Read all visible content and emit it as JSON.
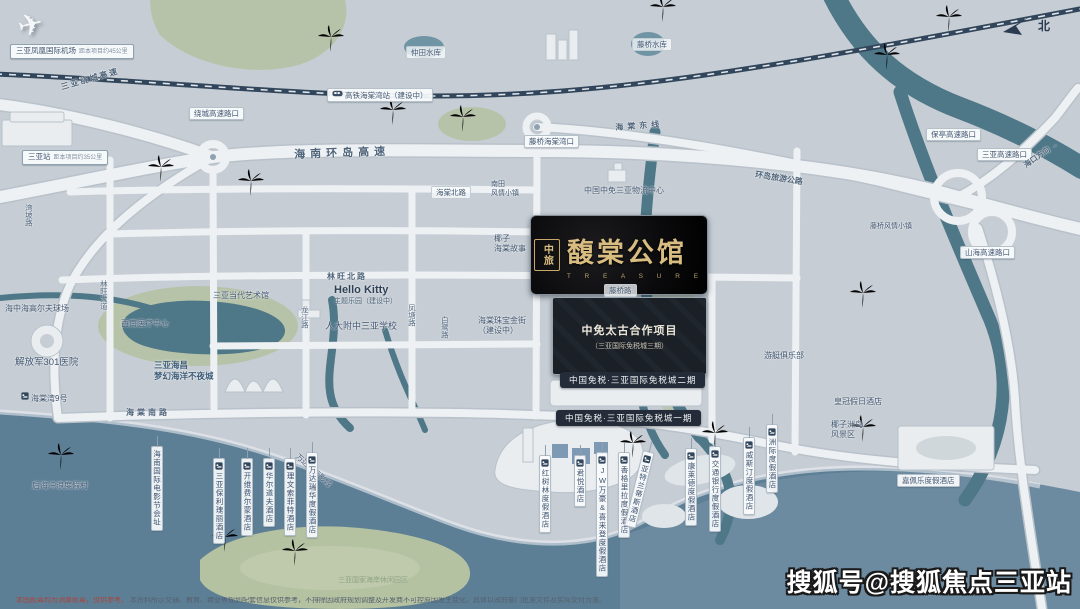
{
  "watermark": "搜狐号@搜狐焦点三亚站",
  "compass_label": "北",
  "logo": {
    "seal": "中旅",
    "name": "馥棠公馆",
    "sub": "T R E A S U R E"
  },
  "duty_free": {
    "project_line1": "中免太古合作项目",
    "project_line2": "（三亚国际免税城三期）",
    "phase2": "中国免税·三亚国际免税城二期",
    "phase1": "中国免税·三亚国际免税城一期"
  },
  "hello_kitty": {
    "title": "Hello Kitty",
    "sub": "主题乐园（建设中）"
  },
  "disclaimer": {
    "red": "本图距离均为测算距离，仅供参考。",
    "gray": "本资料所示交通、教育、商业等规划配套信息仅供参考，不排除因政府规划调整及开发商不可控原因发生变化，具体以政府部门批准文件及实际交付为准。"
  },
  "colors": {
    "bg": "#c6cdd4",
    "sea": "#5d7f96",
    "river": "#4e7787",
    "green": "#b7c3a9",
    "road": "#eef1f4",
    "rail": "#31455b",
    "gold": "#d9bc80",
    "dark_pill": "#232c38"
  },
  "labels": [
    {
      "n": "airport-label",
      "c": "p brd",
      "t": "三亚凤凰国际机场",
      "x": 10,
      "y": 44,
      "note": "距本项目约45公里"
    },
    {
      "n": "sanya-station-label",
      "c": "p brd",
      "t": "三亚站",
      "x": 22,
      "y": 150,
      "note": "距本项目约35公里"
    },
    {
      "n": "rail-station-label",
      "c": "p",
      "t": "高铁海棠湾站（建设中）",
      "x": 327,
      "y": 88,
      "train": 1
    },
    {
      "n": "raocheng-exit-label",
      "c": "p",
      "t": "绕城高速路口",
      "x": 189,
      "y": 107
    },
    {
      "n": "tengqiao-exit-label",
      "c": "p",
      "t": "藤桥海棠湾口",
      "x": 524,
      "y": 135
    },
    {
      "n": "baoting-exit-label",
      "c": "p",
      "t": "保亭高速路口",
      "x": 926,
      "y": 128
    },
    {
      "n": "sanya-exit-label",
      "c": "p",
      "t": "三亚高速路口",
      "x": 977,
      "y": 148
    },
    {
      "n": "shanhai-exit-label",
      "c": "p",
      "t": "山海高速路口",
      "x": 960,
      "y": 246
    },
    {
      "n": "zhongtian-reservoir-label",
      "c": "p soft",
      "t": "仲田水库",
      "x": 406,
      "y": 46
    },
    {
      "n": "tengqiao-reservoir-label",
      "c": "p soft",
      "t": "藤桥水库",
      "x": 632,
      "y": 38
    },
    {
      "n": "haitang-north-road-label",
      "c": "p soft",
      "t": "海棠北路",
      "x": 431,
      "y": 186
    },
    {
      "n": "tengqiao-road-label",
      "c": "p soft",
      "t": "藤桥路",
      "x": 604,
      "y": 284
    },
    {
      "n": "capella-hotel-label",
      "c": "p",
      "t": "嘉佩乐度假酒店",
      "x": 897,
      "y": 474
    },
    {
      "n": "raocheng-expressway-label",
      "c": "lab rt",
      "t": "三亚绕城高速",
      "x": 60,
      "y": 83,
      "rot": -16,
      "sp": 2
    },
    {
      "n": "island-ring-expressway-label",
      "c": "lab rt",
      "t": "海南环岛高速",
      "x": 294,
      "y": 149,
      "rot": -2,
      "sp": 5,
      "size": 11
    },
    {
      "n": "haitang-east-line-label",
      "c": "lab rt",
      "t": "海棠东线",
      "x": 615,
      "y": 123,
      "rot": -4,
      "sp": 4
    },
    {
      "n": "island-tour-road-label",
      "c": "lab rt",
      "t": "环岛旅游公路",
      "x": 756,
      "y": 170,
      "rot": 9
    },
    {
      "n": "haikou-direction-label",
      "c": "lab rt",
      "t": "海口方向 →",
      "x": 1022,
      "y": 162,
      "rot": -35,
      "size": 7.5
    },
    {
      "n": "linwang-north-road-label",
      "c": "lab rt",
      "t": "林旺北路",
      "x": 327,
      "y": 272,
      "sp": 2
    },
    {
      "n": "haitang-south-road-label",
      "c": "lab rt",
      "t": "海棠南路",
      "x": 126,
      "y": 408,
      "sp": 3
    },
    {
      "n": "wanpo-road-label",
      "c": "rv",
      "t": "湾坡路",
      "x": 24,
      "y": 204
    },
    {
      "n": "linwang-avenue-label",
      "c": "rv",
      "t": "林旺大道",
      "x": 99,
      "y": 280
    },
    {
      "n": "longjiang-road-label",
      "c": "rv",
      "t": "龙江路",
      "x": 300,
      "y": 306
    },
    {
      "n": "fengtang-road-label",
      "c": "rv",
      "t": "凤塘路",
      "x": 407,
      "y": 304
    },
    {
      "n": "bailu-road-label",
      "c": "rv",
      "t": "白鹭路",
      "x": 440,
      "y": 316
    },
    {
      "n": "cdf-logistics-label",
      "c": "lab poi",
      "t": "中国中免三亚物流中心",
      "x": 584,
      "y": 186
    },
    {
      "n": "contemporary-art-museum-label",
      "c": "lab poi",
      "t": "三亚当代艺术馆",
      "x": 213,
      "y": 291
    },
    {
      "n": "golf-club-label",
      "c": "lab poi",
      "t": "海中海高尔夫球场",
      "x": 5,
      "y": 304
    },
    {
      "n": "medical-center-label",
      "c": "lab poi",
      "t": "西南医疗中心",
      "x": 121,
      "y": 319
    },
    {
      "n": "hospital-301-label",
      "c": "lab poi",
      "t": "解放军301医院",
      "x": 15,
      "y": 357,
      "size": 9.5
    },
    {
      "n": "haitangwan-no9-label",
      "c": "lab poi",
      "t": "海棠湾9号",
      "x": 21,
      "y": 392,
      "bed": 1
    },
    {
      "n": "nantian-town-label",
      "c": "lab poi",
      "lines": [
        "南田",
        "风情小镇"
      ],
      "x": 491,
      "y": 181,
      "size": 7
    },
    {
      "n": "haichang-ocean-town-label",
      "c": "lab poi strong",
      "lines": [
        "三亚海昌",
        "梦幻海洋不夜城"
      ],
      "x": 154,
      "y": 360,
      "size": 8.5
    },
    {
      "n": "rdfz-school-label",
      "c": "lab poi",
      "t": "人大附中三亚学校",
      "x": 325,
      "y": 321,
      "size": 9
    },
    {
      "n": "jewelry-street-label",
      "c": "lab poi",
      "lines": [
        "海棠珠宝金街",
        "（建设中）"
      ],
      "x": 478,
      "y": 316
    },
    {
      "n": "coconut-story-label",
      "c": "lab poi",
      "lines": [
        "椰子",
        "海棠故事"
      ],
      "x": 494,
      "y": 234
    },
    {
      "n": "yacht-club-label",
      "c": "lab poi",
      "t": "游艇俱乐部",
      "x": 764,
      "y": 351
    },
    {
      "n": "tengqiao-town-label",
      "c": "lab poi",
      "t": "藤桥风情小镇",
      "x": 870,
      "y": 223,
      "size": 7
    },
    {
      "n": "crowne-plaza-label",
      "c": "lab poi",
      "t": "皇冠假日酒店",
      "x": 834,
      "y": 397
    },
    {
      "n": "coconut-island-label",
      "c": "lab poi",
      "lines": [
        "椰子洲岛",
        "风景区"
      ],
      "x": 831,
      "y": 420
    },
    {
      "n": "houhai-surf-label",
      "c": "lab poi",
      "t": "后海冲浪度假村",
      "x": 32,
      "y": 481
    },
    {
      "n": "national-coast-label",
      "c": "lab poi faint",
      "t": "三亚国家海岸休闲园区",
      "x": 338,
      "y": 577,
      "size": 7
    },
    {
      "n": "wanda-cinema-label",
      "c": "lab poi",
      "t": "万达国际影城",
      "x": 300,
      "y": 452,
      "rot": 42,
      "size": 7.5
    },
    {
      "n": "film-festival-label",
      "c": "vp",
      "t": "海南国际电影节会址",
      "x": 151,
      "y": 446,
      "nobed": 1
    },
    {
      "n": "hotel-baoli-label",
      "c": "vp",
      "t": "三亚保利瑰丽酒店",
      "x": 213,
      "y": 458,
      "bed": 1
    },
    {
      "n": "hotel-fairmont-label",
      "c": "vp",
      "t": "开维费尔蒙酒店",
      "x": 241,
      "y": 458,
      "bed": 1
    },
    {
      "n": "hotel-waldorf-label",
      "c": "vp",
      "t": "华尔道夫酒店",
      "x": 263,
      "y": 458,
      "bed": 1
    },
    {
      "n": "hotel-sofitel-label",
      "c": "vp",
      "t": "理文索菲特酒店",
      "x": 284,
      "y": 458,
      "bed": 1
    },
    {
      "n": "hotel-wanda-label",
      "c": "vp",
      "t": "万达瑞华度假酒店",
      "x": 306,
      "y": 452,
      "bed": 1
    },
    {
      "n": "hotel-mangrove-label",
      "c": "vp",
      "t": "红树林度假酒店",
      "x": 539,
      "y": 455,
      "bed": 1
    },
    {
      "n": "hotel-grand-hyatt-label",
      "c": "vp",
      "t": "君悦酒店",
      "x": 574,
      "y": 455,
      "bed": 1
    },
    {
      "n": "hotel-jw-marriott-label",
      "c": "vp",
      "t": "JW万豪&喜来登度假酒店",
      "x": 596,
      "y": 452,
      "bed": 1
    },
    {
      "n": "hotel-shangrila-label",
      "c": "vp",
      "t": "香格里拉度假酒店",
      "x": 618,
      "y": 452,
      "bed": 1
    },
    {
      "n": "hotel-atlantis-label",
      "c": "vp",
      "t": "亚特兰蒂斯酒店",
      "x": 643,
      "y": 450,
      "rot": 14,
      "bed": 1
    },
    {
      "n": "hotel-conrad-label",
      "c": "vp",
      "t": "康莱德度假酒店",
      "x": 685,
      "y": 448,
      "bed": 1
    },
    {
      "n": "hotel-bank-resort-label",
      "c": "vp",
      "t": "交通银行度假酒店",
      "x": 709,
      "y": 446,
      "bed": 1
    },
    {
      "n": "hotel-westin-label",
      "c": "vp",
      "t": "威斯汀度假酒店",
      "x": 743,
      "y": 437,
      "bed": 1
    },
    {
      "n": "hotel-intercontinental-label",
      "c": "vp",
      "t": "洲际度假酒店",
      "x": 766,
      "y": 424,
      "bed": 1
    }
  ]
}
